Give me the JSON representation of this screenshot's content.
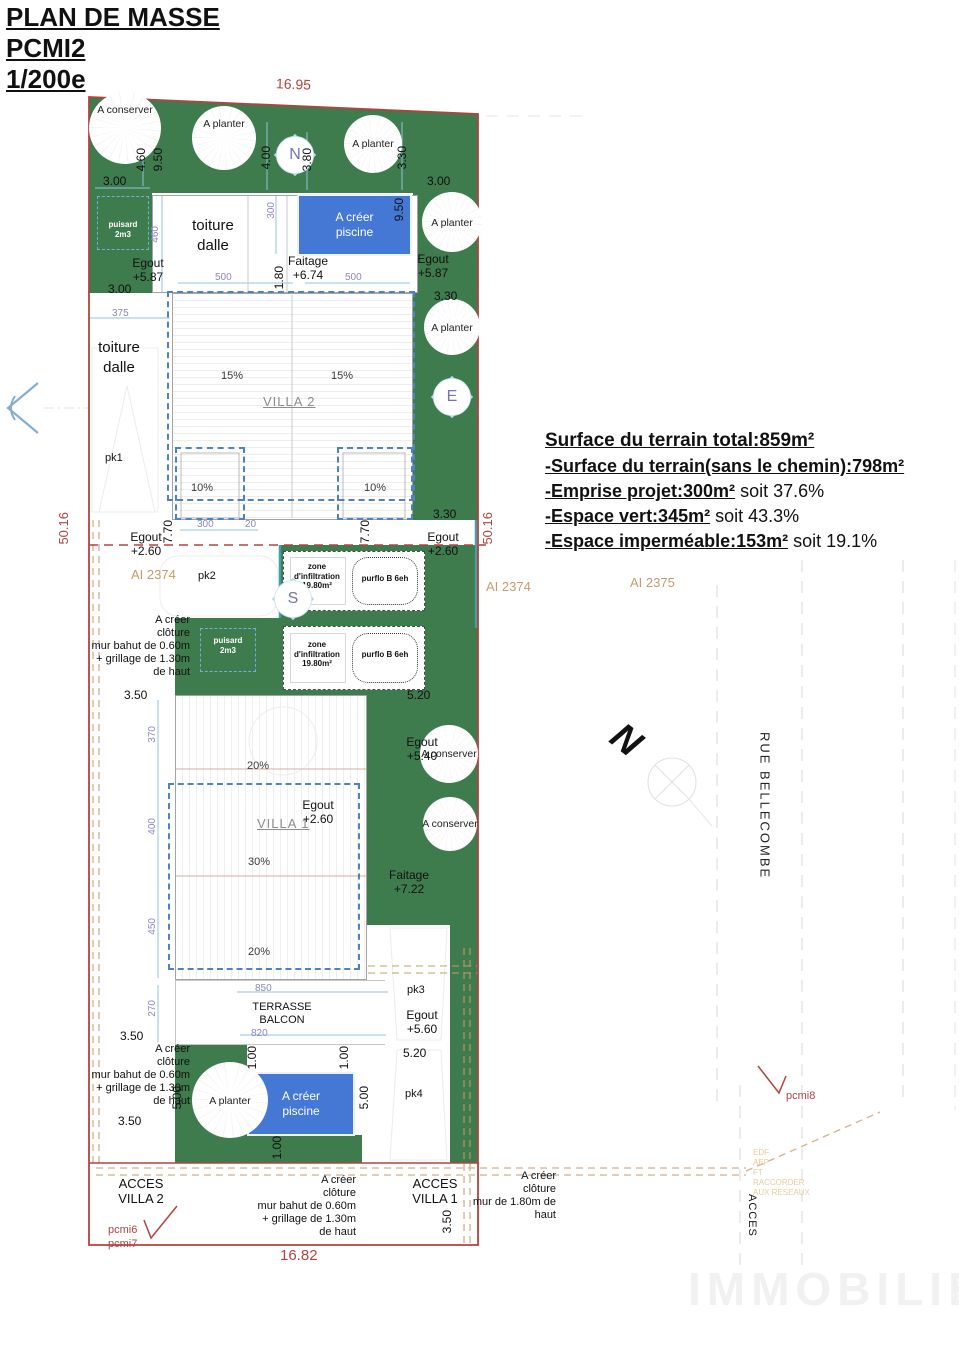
{
  "colors": {
    "green": "#3e7b4d",
    "pool": "#4478d4",
    "red": "#b5423f",
    "dashblue": "#4d82c4",
    "ltblue": "#b5d9ea",
    "teal": "#3fa0a8",
    "purple": "#8787c9",
    "tan": "#c59d6b",
    "tanl": "#e3cf9a"
  },
  "title": {
    "l1": "PLAN DE MASSE",
    "l2": "PCMI2",
    "l3": "1/200e"
  },
  "boundary": {
    "top": "16.95",
    "bottom": "16.82",
    "left": "50.16",
    "right": "50.16"
  },
  "surface": {
    "title": "Surface du terrain total:859m²",
    "items": [
      {
        "strong": "-Surface du terrain(sans le chemin):798m²",
        "rest": ""
      },
      {
        "strong": "-Emprise projet:300m²",
        "rest": " soit 37.6%"
      },
      {
        "strong": "-Espace vert:345m²",
        "rest": " soit 43.3%"
      },
      {
        "strong": "-Espace imperméable:153m²",
        "rest": " soit 19.1%"
      }
    ]
  },
  "trees": {
    "conserver": "A conserver",
    "planter": "A planter"
  },
  "compass": {
    "n": "N",
    "e": "E",
    "s": "S",
    "big_n": "N"
  },
  "buildings": {
    "villa1": "VILLA 1",
    "villa2": "VILLA 2",
    "toiture": "toiture\ndalle",
    "pool": "A créer\npiscine",
    "terrasse": "TERRASSE\nBALCON",
    "pk1": "pk1",
    "pk2": "pk2",
    "pk3": "pk3",
    "pk4": "pk4"
  },
  "slopes": {
    "p15": "15%",
    "p10": "10%",
    "p20": "20%",
    "p30": "30%"
  },
  "levels": {
    "egout587": "Egout\n+5.87",
    "egout260": "Egout\n+2.60",
    "egout540": "Egout\n+5.40",
    "egout560": "Egout\n+5.60",
    "faitage674": "Faitage\n+6.74",
    "faitage722": "Faitage\n+7.22"
  },
  "equipment": {
    "puisard": "puisard\n2m3",
    "zone": "zone\nd'infiltration\n19.80m²",
    "filter": "purflo B 6eh"
  },
  "fences": {
    "bahut": "A créer\nclôture\nmur bahut de 0.60m\n+ grillage de 1.30m\nde haut",
    "mur180": "A créer\nclôture\nmur de 1.80m de\nhaut"
  },
  "access": {
    "villa2": "ACCES\nVILLA 2",
    "villa1": "ACCES\nVILLA 1",
    "road_access": "ACCES"
  },
  "parcels": {
    "ai2374": "AI 2374",
    "ai2375": "AI 2375"
  },
  "road": {
    "name": "RUE BELLECOMBE",
    "utilities": "EDF\nAEP\nFT\nRACCORDER\nAUX RESEAUX"
  },
  "photos": {
    "pcmi6": "pcmi6",
    "pcmi7": "pcmi7",
    "pcmi8": "pcmi8"
  },
  "watermark": "IMMOBILIER",
  "dims": {
    "d300": "3.00",
    "d330": "3.30",
    "d350": "3.50",
    "d380": "3.80",
    "d400": "4.00",
    "d460": "4.60",
    "d520": "5.20",
    "d500": "5.00",
    "d100": "1.00",
    "d180": "1.80",
    "d770": "7.70",
    "d950": "9.50",
    "m20": "20",
    "m270": "270",
    "m300": "300",
    "m370": "370",
    "m375": "375",
    "m400": "400",
    "m450": "450",
    "m460": "460",
    "m500": "500",
    "m820": "820",
    "m850": "850"
  }
}
